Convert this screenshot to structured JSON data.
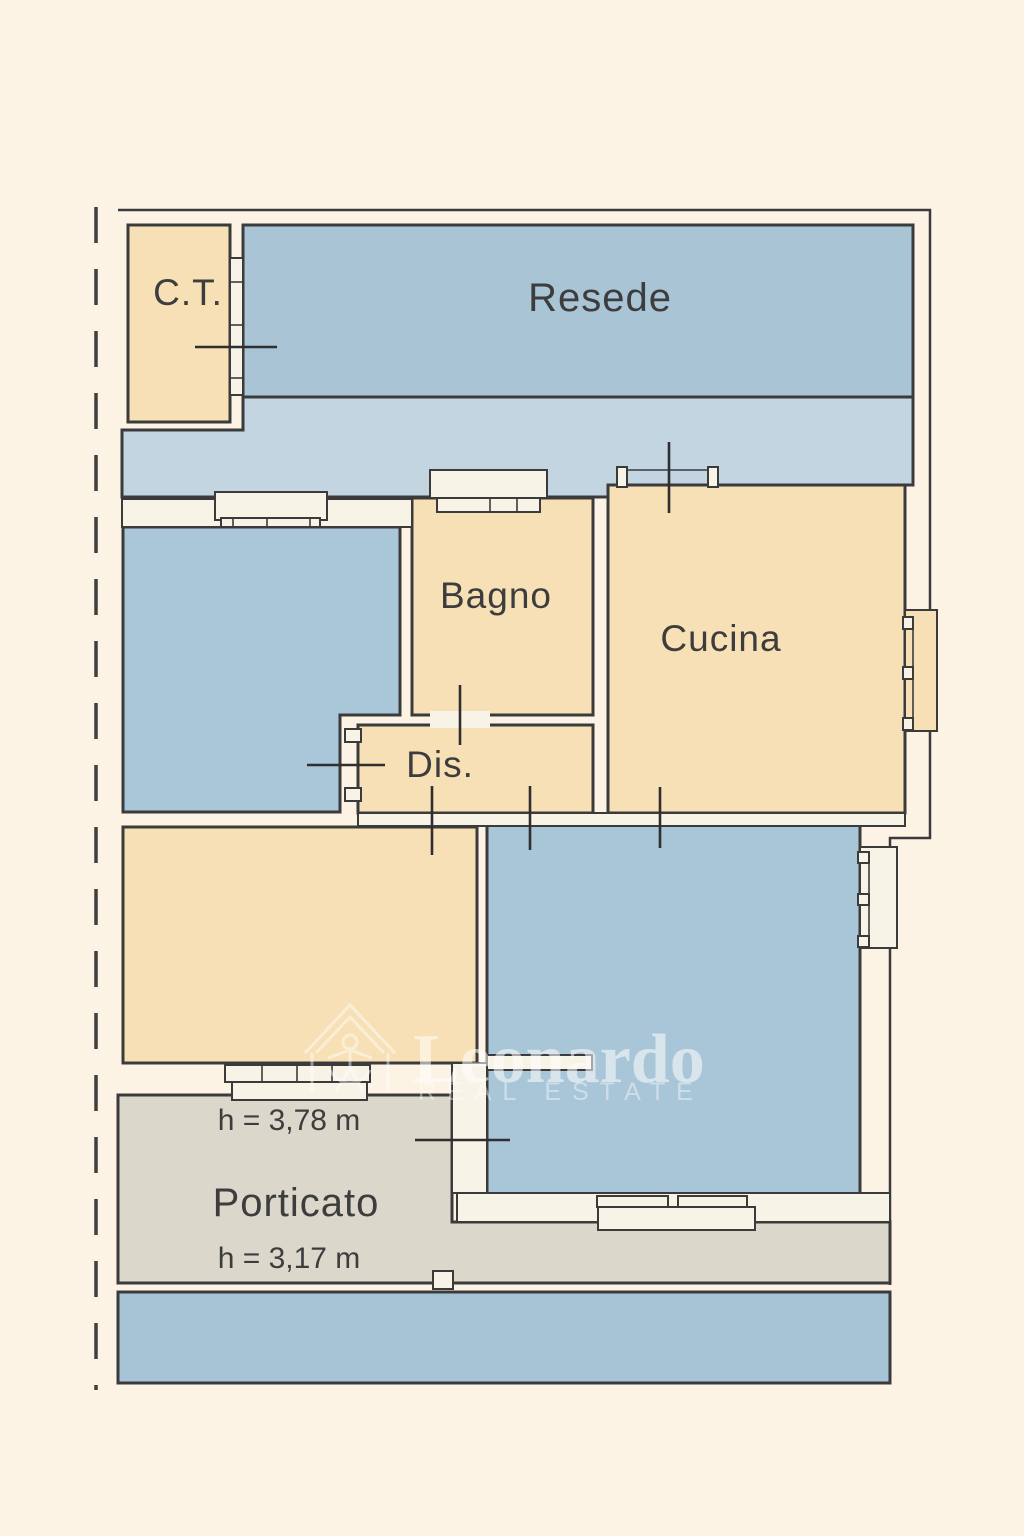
{
  "plan": {
    "type": "floor-plan",
    "rooms": {
      "ct": {
        "label": "C.T."
      },
      "resede": {
        "label": "Resede"
      },
      "bagno": {
        "label": "Bagno"
      },
      "cucina": {
        "label": "Cucina"
      },
      "dis": {
        "label": "Dis."
      },
      "porticato": {
        "label": "Porticato"
      }
    },
    "annotations": {
      "upper_room_height": "h = 3,78 m",
      "porticato_height": "h = 3,17 m"
    }
  },
  "watermark": {
    "brand": "Leonardo",
    "tagline": "REAL ESTATE"
  },
  "palette": {
    "page_bg": "#fdf3e5",
    "cream_room": "#f7e0b5",
    "resede_blue": "#a9c4d5",
    "corridor_blue": "#c2d5e1",
    "mid_blue": "#aac7d9",
    "bottom_room_blue": "#a9c6d8",
    "strip_blue": "#a6c4d6",
    "porticato_gray": "#dbd7cb",
    "wall_white": "#f8f3e7",
    "line": "#3b3b3b",
    "text": "#3d3d3d"
  }
}
